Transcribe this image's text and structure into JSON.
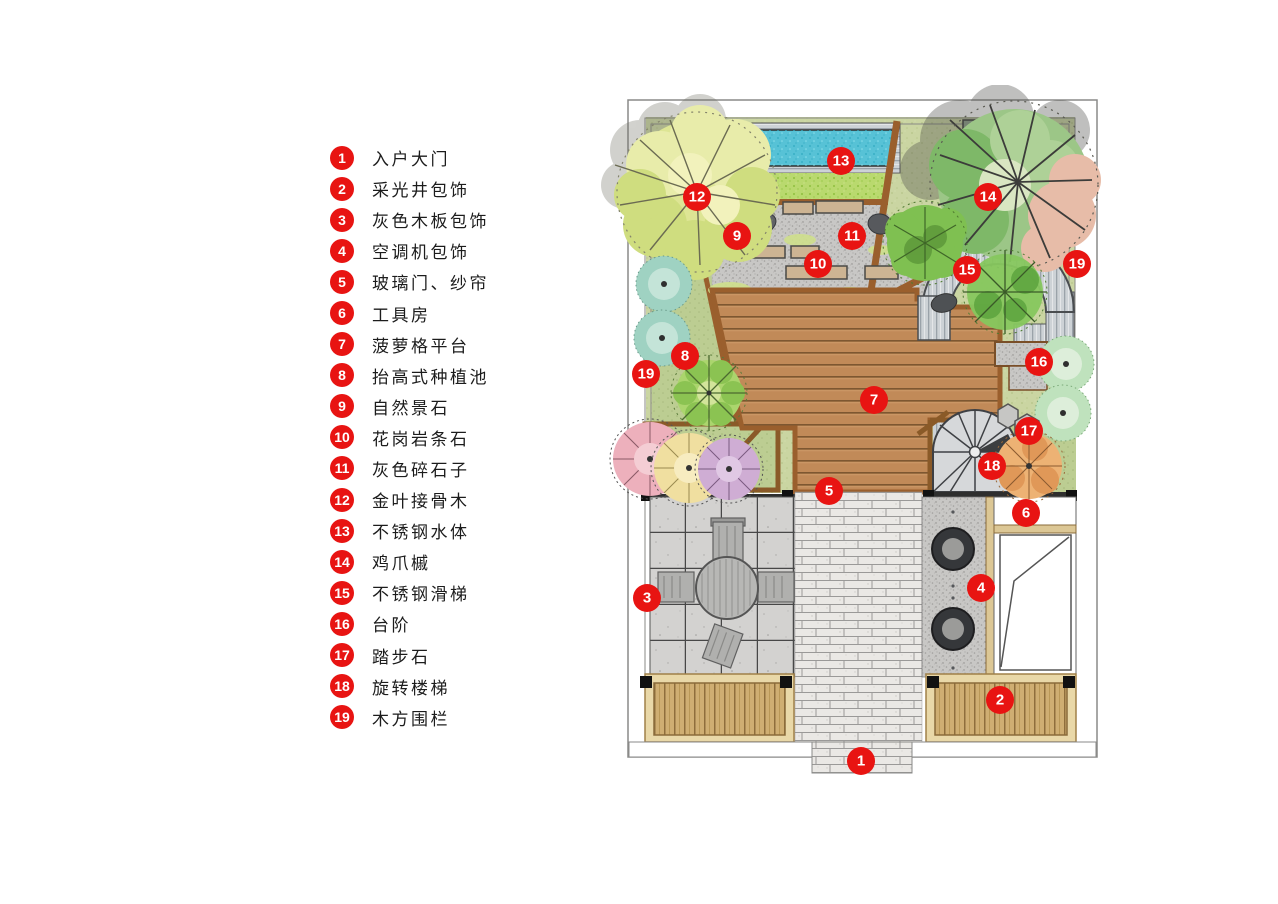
{
  "legend": {
    "items": [
      {
        "num": "1",
        "label": "入户大门"
      },
      {
        "num": "2",
        "label": "采光井包饰"
      },
      {
        "num": "3",
        "label": "灰色木板包饰"
      },
      {
        "num": "4",
        "label": "空调机包饰"
      },
      {
        "num": "5",
        "label": "玻璃门、纱帘"
      },
      {
        "num": "6",
        "label": "工具房"
      },
      {
        "num": "7",
        "label": "菠萝格平台"
      },
      {
        "num": "8",
        "label": "抬高式种植池"
      },
      {
        "num": "9",
        "label": "自然景石"
      },
      {
        "num": "10",
        "label": "花岗岩条石"
      },
      {
        "num": "11",
        "label": "灰色碎石子"
      },
      {
        "num": "12",
        "label": "金叶接骨木"
      },
      {
        "num": "13",
        "label": "不锈钢水体"
      },
      {
        "num": "14",
        "label": "鸡爪槭"
      },
      {
        "num": "15",
        "label": "不锈钢滑梯"
      },
      {
        "num": "16",
        "label": "台阶"
      },
      {
        "num": "17",
        "label": "踏步石"
      },
      {
        "num": "18",
        "label": "旋转楼梯"
      },
      {
        "num": "19",
        "label": "木方围栏"
      }
    ]
  },
  "plan": {
    "markers": [
      {
        "num": "1",
        "x": 861,
        "y": 761
      },
      {
        "num": "2",
        "x": 1000,
        "y": 700
      },
      {
        "num": "3",
        "x": 647,
        "y": 598
      },
      {
        "num": "4",
        "x": 981,
        "y": 588
      },
      {
        "num": "5",
        "x": 829,
        "y": 491
      },
      {
        "num": "6",
        "x": 1026,
        "y": 513
      },
      {
        "num": "7",
        "x": 874,
        "y": 400
      },
      {
        "num": "8",
        "x": 685,
        "y": 356
      },
      {
        "num": "9",
        "x": 737,
        "y": 236
      },
      {
        "num": "10",
        "x": 818,
        "y": 264
      },
      {
        "num": "11",
        "x": 852,
        "y": 236
      },
      {
        "num": "12",
        "x": 697,
        "y": 197
      },
      {
        "num": "13",
        "x": 841,
        "y": 161
      },
      {
        "num": "14",
        "x": 988,
        "y": 197
      },
      {
        "num": "15",
        "x": 967,
        "y": 270
      },
      {
        "num": "16",
        "x": 1039,
        "y": 362
      },
      {
        "num": "17",
        "x": 1029,
        "y": 431
      },
      {
        "num": "18",
        "x": 992,
        "y": 466
      },
      {
        "num": "19",
        "x": 646,
        "y": 374
      },
      {
        "num": "19",
        "x": 1077,
        "y": 264
      }
    ]
  },
  "colors": {
    "marker": "#e81412",
    "marker_text": "#ffffff"
  }
}
